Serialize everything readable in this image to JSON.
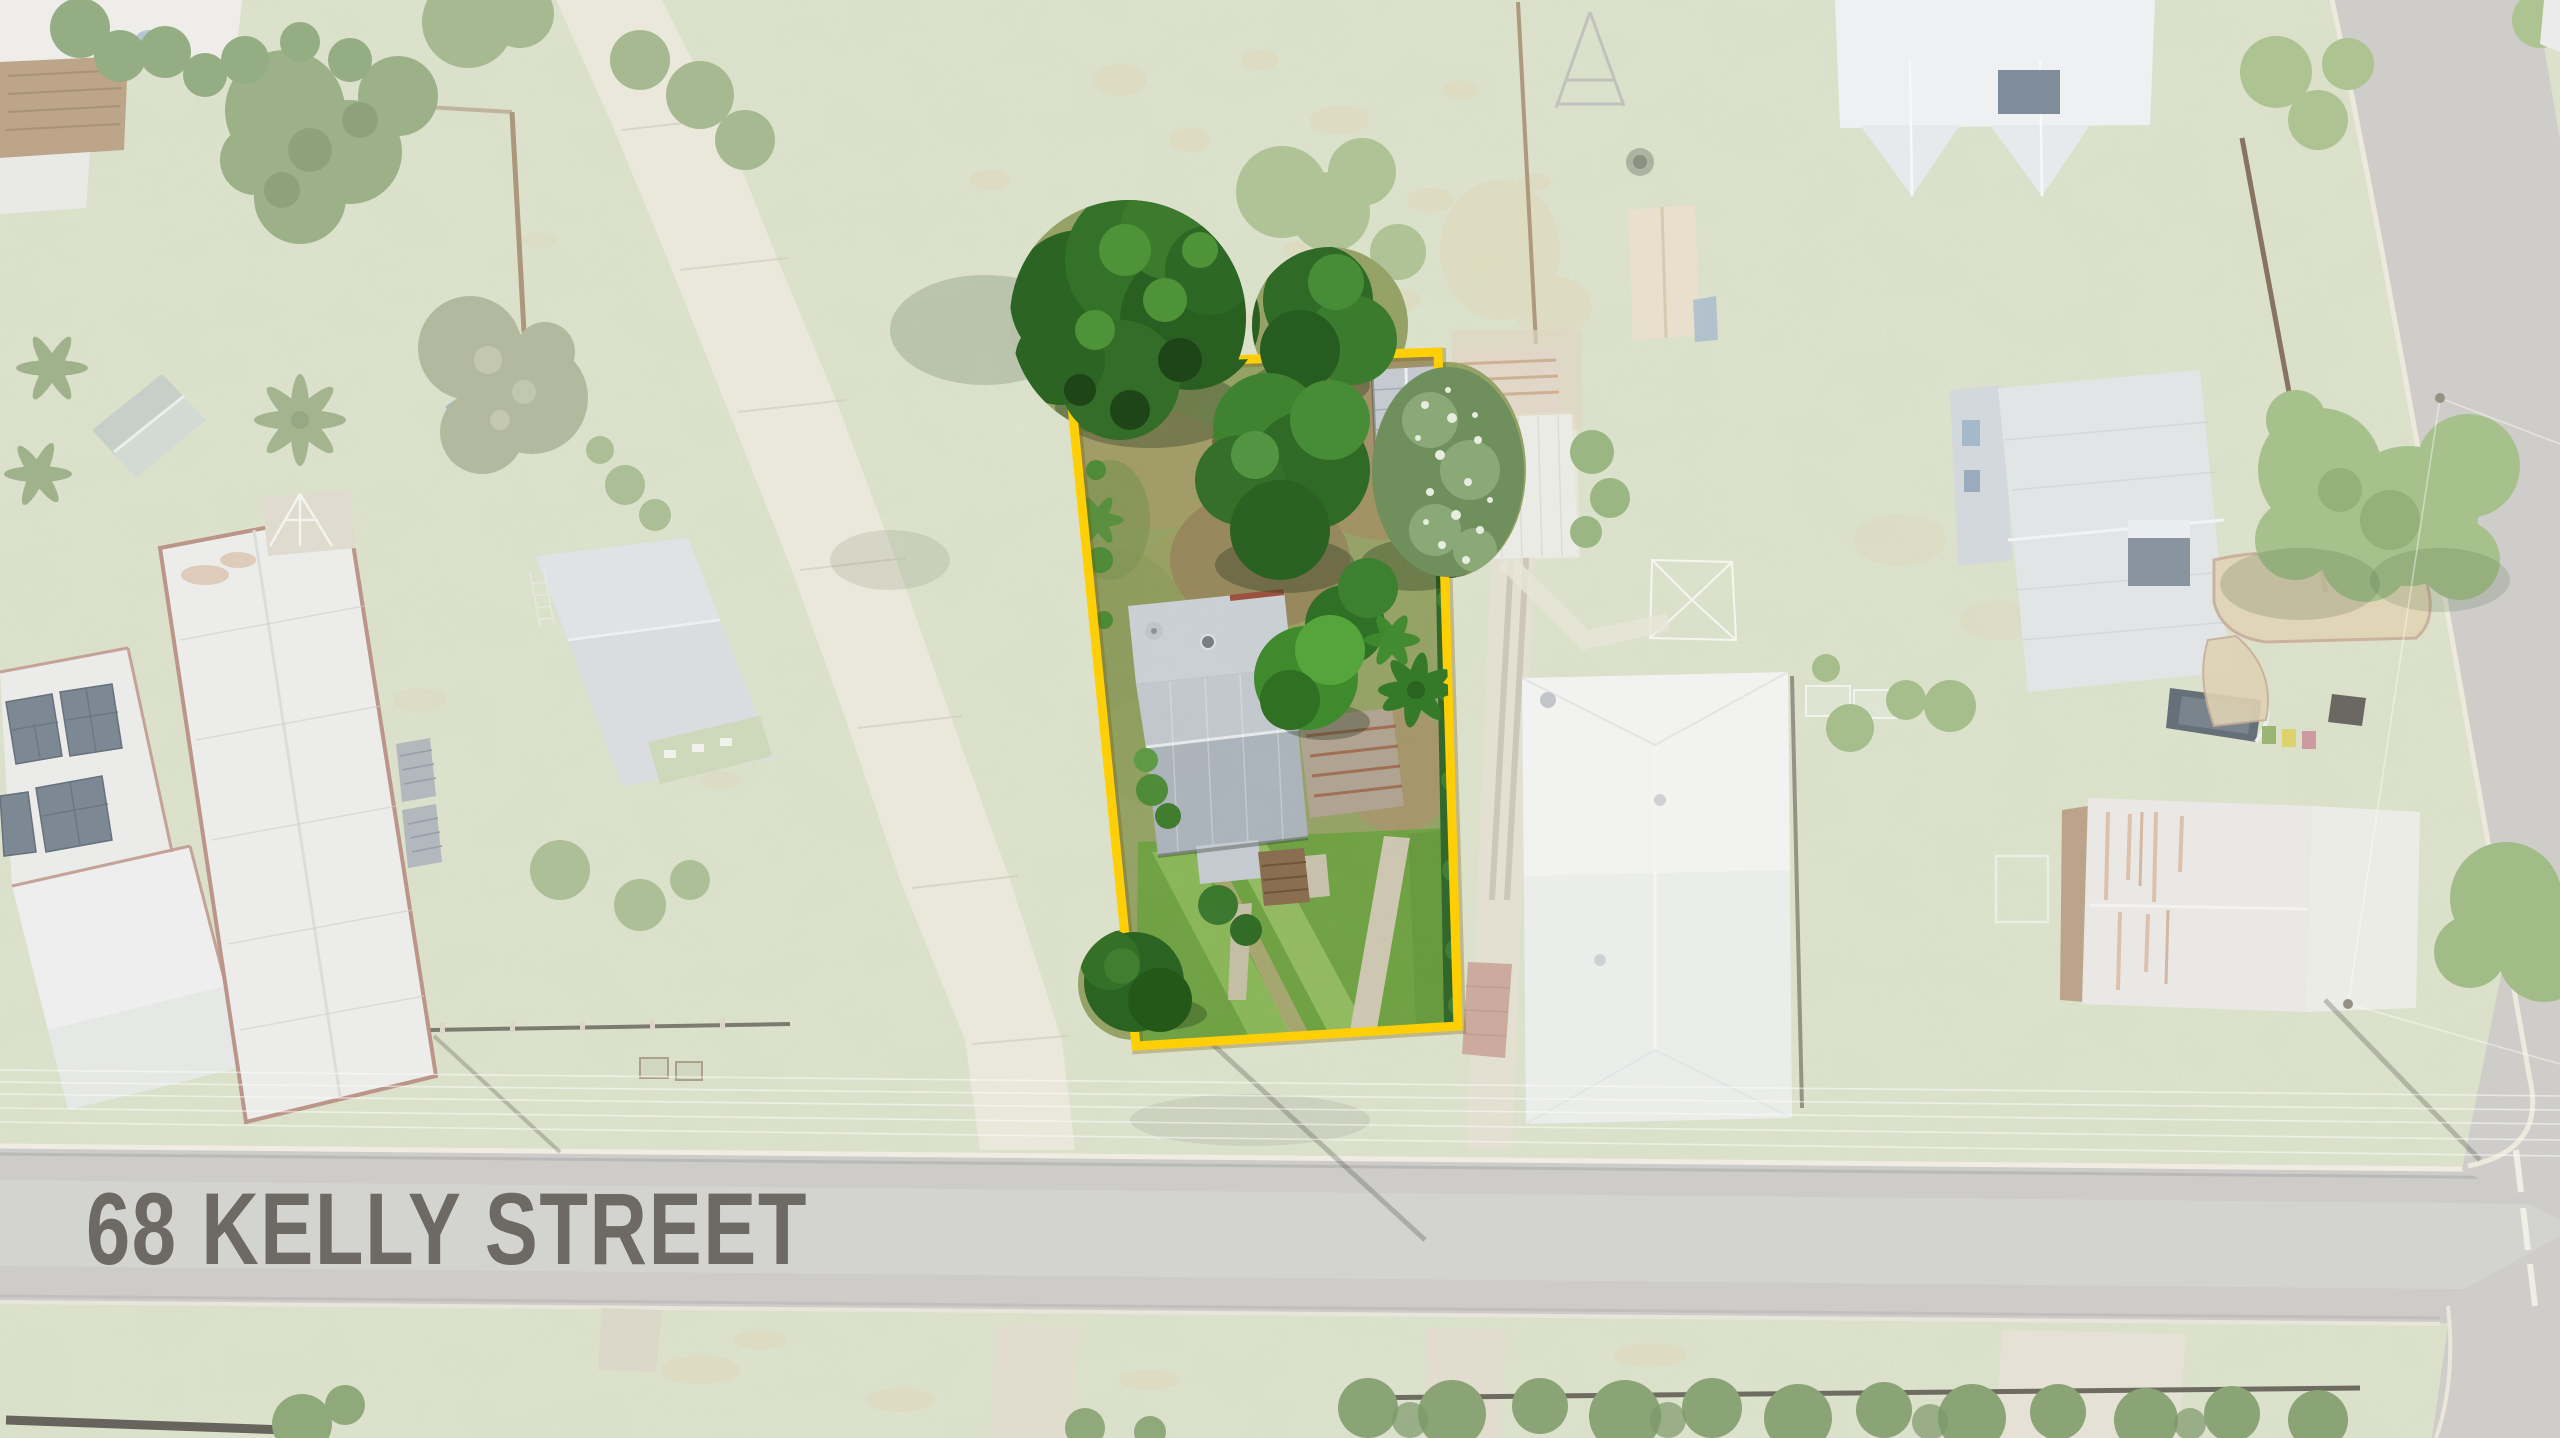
{
  "scene": {
    "type": "aerial-drone-property-photo",
    "address_label": "68 KELLY STREET",
    "label_color": "#4F4B46",
    "boundary_color": "#FFCF06"
  }
}
